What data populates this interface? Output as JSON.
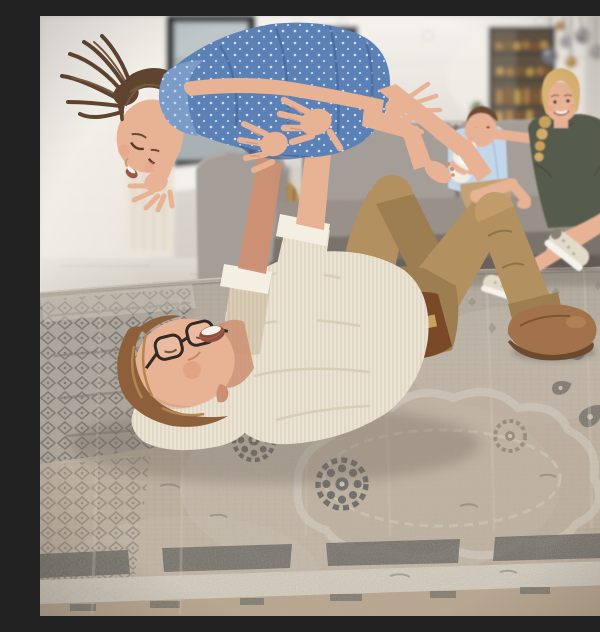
{
  "scene": {
    "caption": "Candid family photo in a bright modern living room: a laughing father in glasses, a cream knit shirt, khaki chinos and brown suede boots lies on his back on a vintage beige-and-charcoal medallion area rug, lifting his daughter, a girl in a blue polka-dot dress with a brown ponytail, into the air above him; a smiling blonde mother in an olive top and pale sneakers and a barefoot baby boy hugging a white teddy bear watch from a gray sectional sofa.",
    "setting": "bright open-plan living room with white walls, tiled floor, staircase and kitchen bar in the background",
    "subjects": {
      "father": "man with auburn hair and dark-rimmed glasses, cream ribbed long-sleeve shirt with rolled cuffs, brown belt, khaki trousers, brown suede boots, lying on the rug holding the girl aloft",
      "daughter": "young girl with a brown ponytail, blue dress with tiny white print, bare arms and legs outstretched, laughing face-down over her father",
      "mother": "blonde woman with a side braid, olive-green short-sleeve top, bare crossed legs, beige-white sneakers, seated on the sofa smiling",
      "baby": "toddler boy with brown hair, light-blue shirt, khaki shorts, barefoot, hugging a white teddy bear on the sofa"
    },
    "objects": [
      "gray sectional sofa",
      "vintage beige and charcoal medallion area rug with distressed pattern and dark border band",
      "sheer curtains",
      "dark-framed window",
      "dark staircase silhouette",
      "glass drinks cabinet with amber bottles",
      "cluster of smoked-glass and amber globe pendant lights",
      "recessed ceiling spotlights",
      "white structural pillar",
      "woven basket",
      "white teddy bear"
    ]
  },
  "palette": {
    "wall_left": "#f0ebe4",
    "wall_back": "#d7d2cb",
    "pillar": "#f7f5f1",
    "window_frame": "#2f3439",
    "window_glass": "#a9b1b5",
    "stairs": "#3c3f44",
    "curtain": "#eae2d4",
    "floor": "#d9d3ca",
    "hallway": "#d5d0c8",
    "cabinet_wood": "#5d5143",
    "bottle_amber": "#b5813c",
    "pendant_smoke": "#75747a",
    "pendant_amber": "#b8873e",
    "couch": "#989089",
    "couch_light": "#a59d98",
    "couch_dark": "#7a736c",
    "couch_base": "#68615b",
    "basket": "#b18a50",
    "skin": "#e8b295",
    "skin_shade": "#cd8f72",
    "mom_hair": "#d9b371",
    "mom_top": "#575b4d",
    "sneaker": "#e2dbca",
    "baby_hair": "#6a4830",
    "baby_shirt": "#c3d7ea",
    "baby_shorts": "#c2a175",
    "teddy": "#f1ede2",
    "dad_hair": "#8d5f3a",
    "shirt": "#ebe3d3",
    "shirt_shade": "#d9cdb6",
    "cuff": "#f4efe3",
    "pants": "#b3905f",
    "pants_light": "#c09c6a",
    "pants_dark": "#9d7e50",
    "belt": "#7a4a28",
    "boot": "#a2734a",
    "boot_sole": "#6b4a30",
    "girl_hair": "#5f4430",
    "dress": "#5b81b6",
    "dress_light": "#7b9cc8",
    "dress_dark": "#41639a",
    "rug_base": "#c2b09a",
    "rug_cool": "#aaa296",
    "rug_cream": "#e9e2d2",
    "rug_gray": "#8a8479",
    "rug_warm": "#c0a584",
    "rug_charcoal": "#4b4a45",
    "shadow": "#6e655a"
  }
}
